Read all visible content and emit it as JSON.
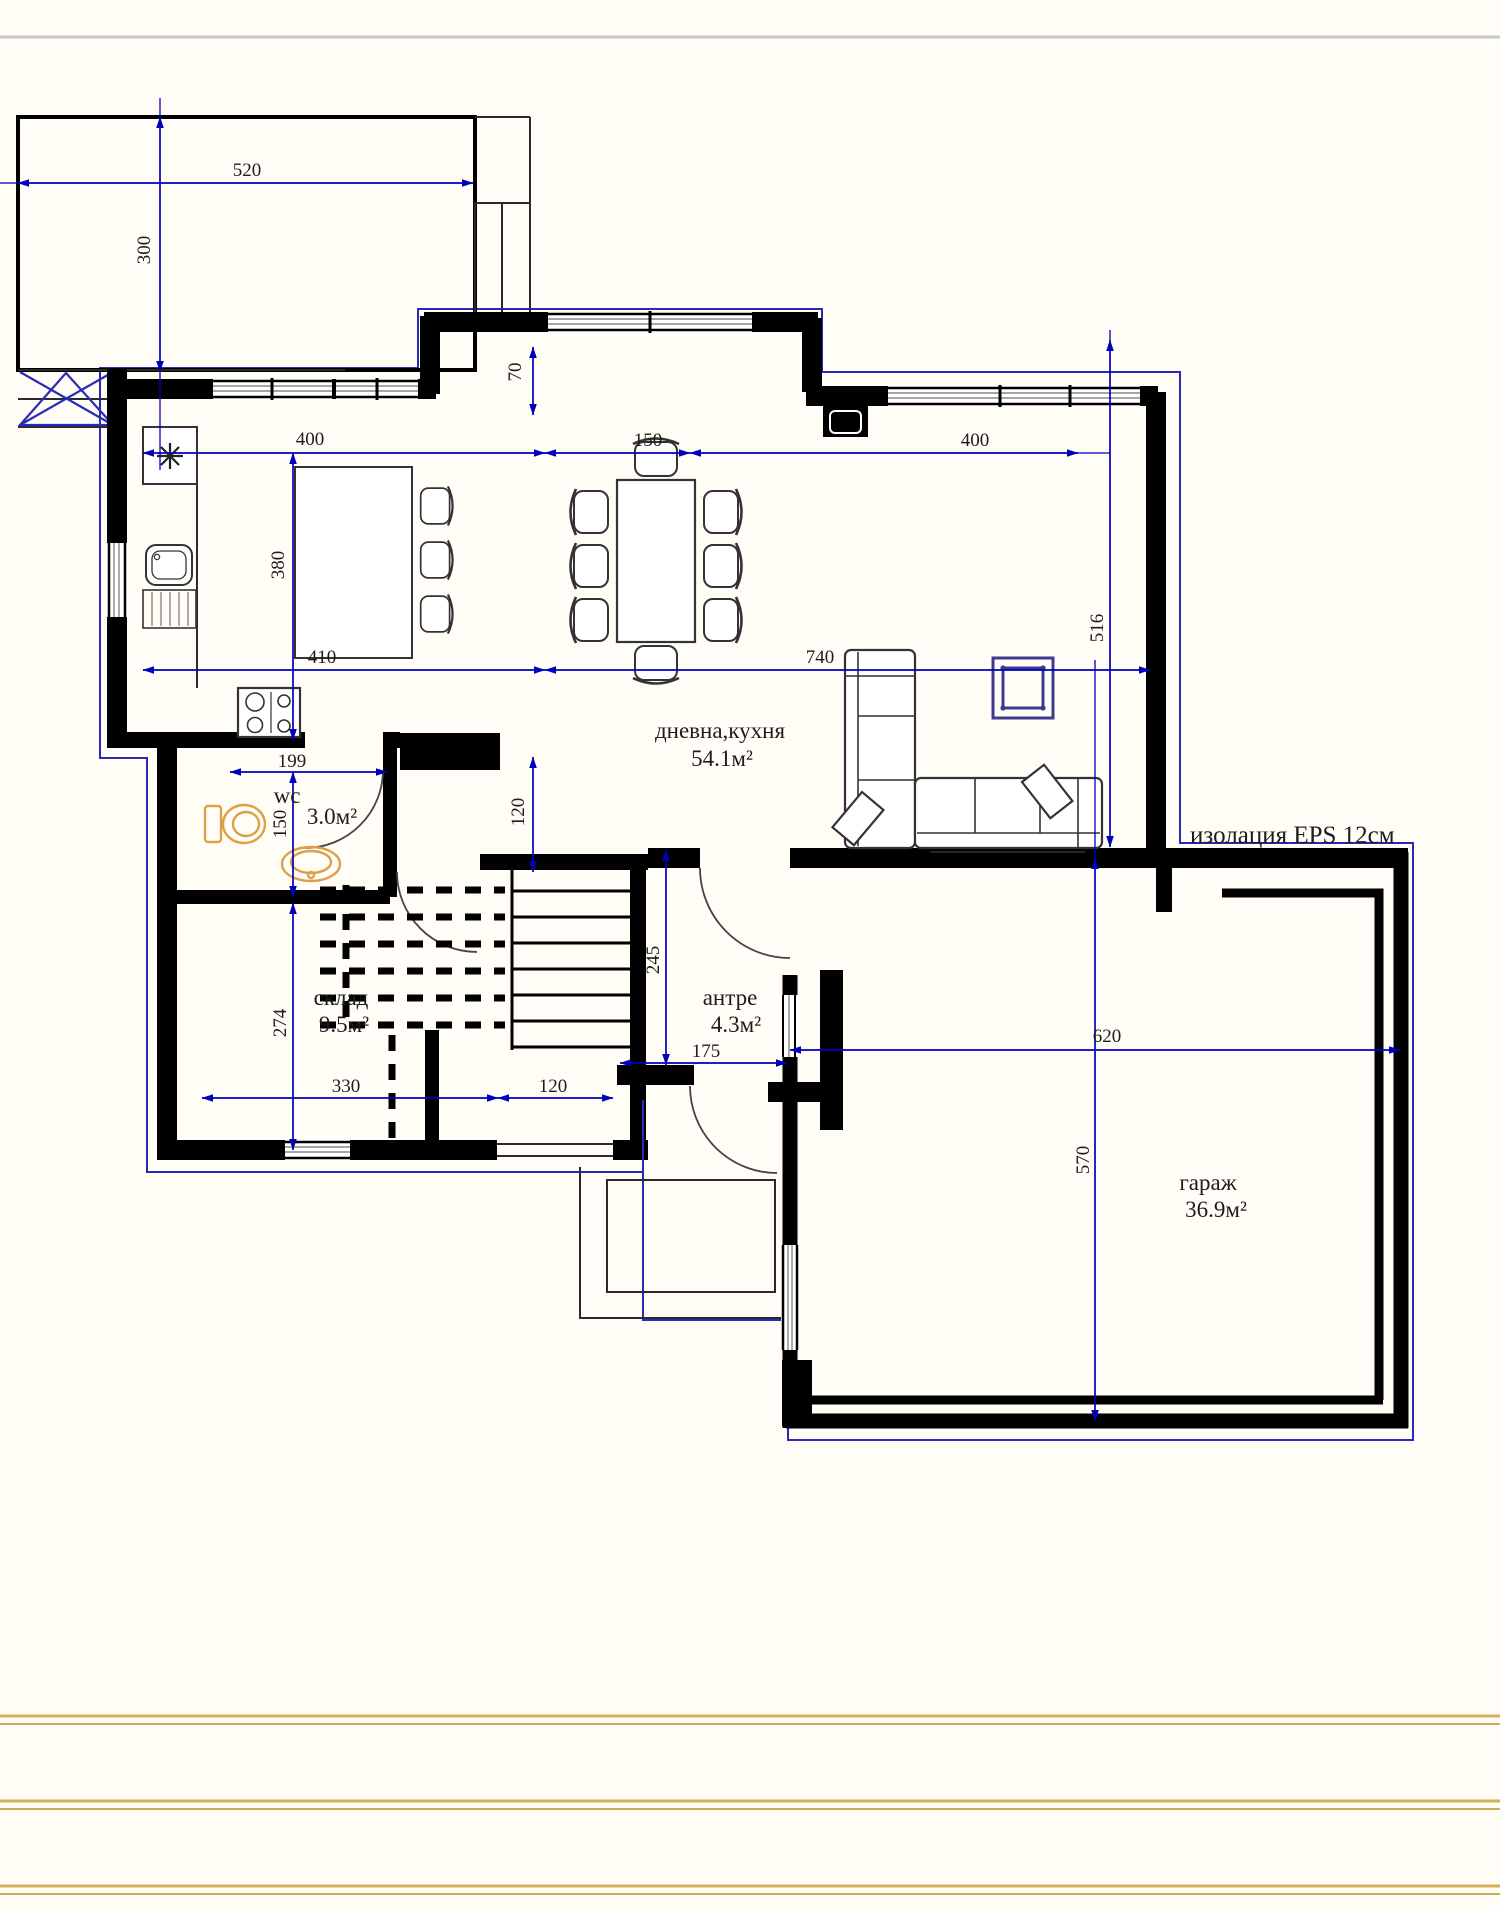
{
  "plan": {
    "rooms": {
      "living": {
        "name": "дневна,кухня",
        "area": "54.1м²"
      },
      "wc": {
        "name": "wc",
        "area": "3.0м²"
      },
      "storage": {
        "name": "склад",
        "area": "9.5м²"
      },
      "hall": {
        "name": "антре",
        "area": "4.3м²"
      },
      "garage": {
        "name": "гараж",
        "area": "36.9м²"
      }
    },
    "annotations": {
      "insulation": "изолация EPS 12см"
    },
    "dims": {
      "terrace_width": "520",
      "terrace_height": "300",
      "wall_step": "70",
      "top_left": "400",
      "top_mid": "150",
      "top_right": "400",
      "kitchen_depth": "380",
      "kitchen_width": "410",
      "living_width": "740",
      "living_height": "516",
      "wc_width": "199",
      "wc_height": "150",
      "stair_opening": "120",
      "hall_depth": "245",
      "hall_width": "175",
      "storage_height": "274",
      "storage_width": "330",
      "bottom_door": "120",
      "garage_width": "620",
      "garage_height": "570"
    },
    "colors": {
      "wall": "#000000",
      "dimension_blue": "#0000bb",
      "insulation_blue": "#2a2ab8",
      "fixture_orange": "#dd9f4a",
      "accent_navy": "#3c3c8e",
      "footer_gold": "#c9a53f",
      "top_rule_gray": "#c8c8c8"
    }
  }
}
